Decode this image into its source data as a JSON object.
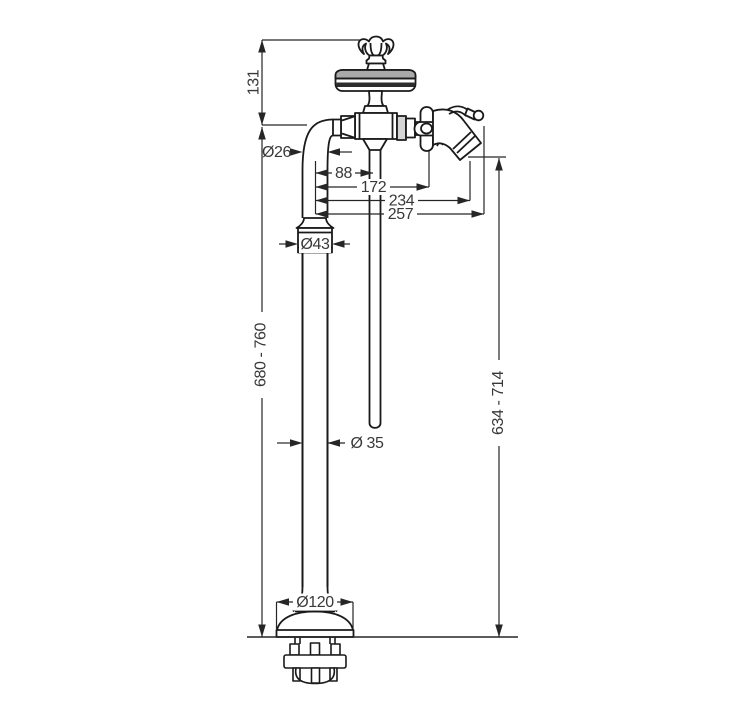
{
  "drawing": {
    "background": "#ffffff",
    "line_color": "#1a1a1a",
    "dimension_color": "#262626",
    "shade_gray": "#a9a9a9",
    "dark_band": "#2d2d2d",
    "labels": {
      "height_top": "131",
      "pipe_diameter": "Ø26",
      "offset_spray": "88",
      "offset_handle": "172",
      "offset_outlet": "234",
      "offset_total": "257",
      "collar_diameter": "Ø43",
      "height_range_left": "680 - 760",
      "column_diameter": "Ø 35",
      "height_range_right": "634 - 714",
      "base_diameter": "Ø120"
    }
  }
}
